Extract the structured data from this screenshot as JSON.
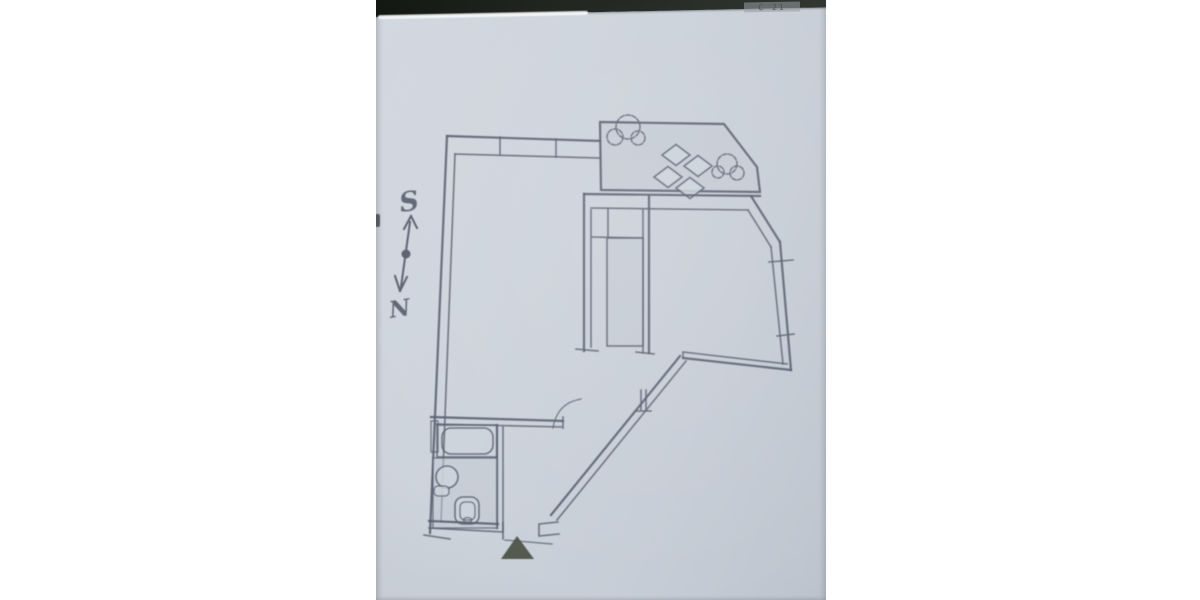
{
  "colors": {
    "page_bg": "#ffffff",
    "paper": "#cdd3db",
    "ink": "#596070",
    "band": "#1c211c",
    "arrow_fill": "#4e5349",
    "header_ink": "#41464d"
  },
  "photo": {
    "description": "photograph of a hand-drafted apartment floor plan on paper",
    "header_text": "C 21"
  },
  "compass": {
    "south_label": "S",
    "north_label": "N"
  },
  "drawing": {
    "type": "floor-plan",
    "elements": [
      "walls",
      "window-openings",
      "terrace-tiles",
      "plants",
      "diamond-inlay",
      "staircase-tiles",
      "bathtub",
      "washbasin",
      "toilet",
      "tiled-bath-floor",
      "door-swing",
      "diagonal-wall",
      "entrance-arrow",
      "compass-needle"
    ]
  }
}
